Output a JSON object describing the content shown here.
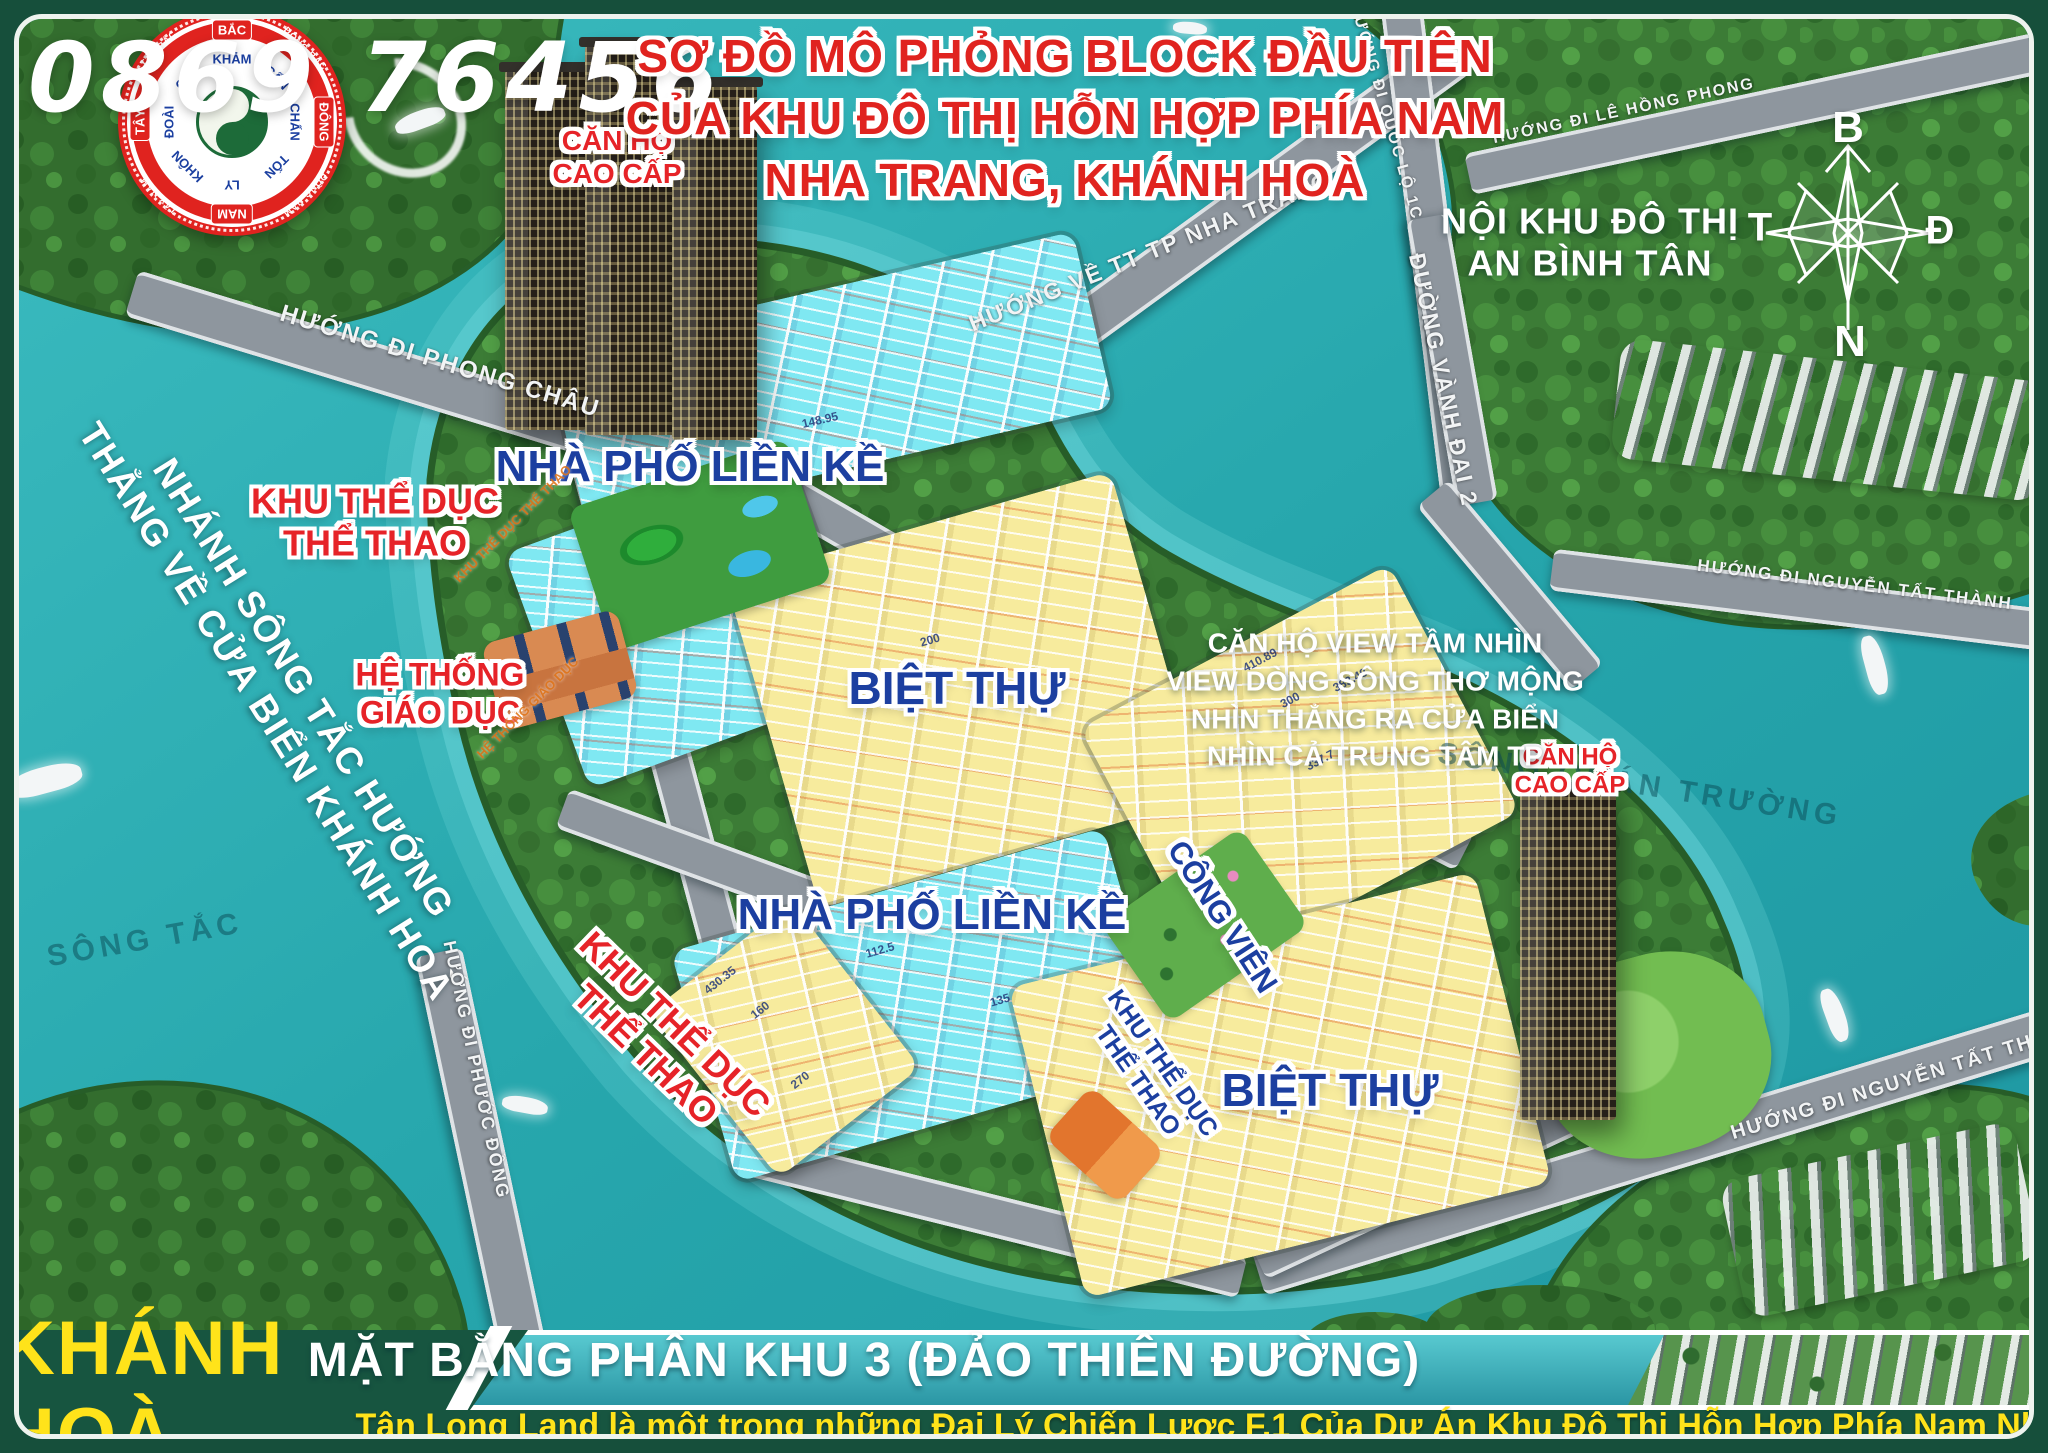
{
  "phone": {
    "part1": "0869",
    "part2": "76456"
  },
  "logo": {
    "cardinals": {
      "n": "BẮC",
      "e": "ĐÔNG",
      "s": "NAM",
      "w": "TÂY"
    },
    "intercardinals": {
      "ne": "ĐÔNG BẮC",
      "se": "ĐÔNG NAM",
      "sw": "TÂY NAM",
      "nw": "TÂY BẮC"
    },
    "trigrams": [
      "KHẢM",
      "CẤN",
      "CHẤN",
      "TỐN",
      "LY",
      "KHÔN",
      "ĐOÀI",
      "CÀN"
    ]
  },
  "title": {
    "line1": "SƠ ĐỒ MÔ PHỎNG BLOCK ĐẦU TIÊN",
    "line2": "CỦA KHU ĐÔ THỊ HỖN HỢP PHÍA NAM",
    "line3": "NHA TRANG, KHÁNH HOÀ"
  },
  "compass": {
    "north": "B",
    "east": "Đ",
    "south": "N",
    "west": "T"
  },
  "labels": {
    "noi_khu_line1": "NỘI KHU ĐÔ THỊ",
    "noi_khu_line2": "AN BÌNH TÂN",
    "can_ho_top_line1": "CĂN HỘ",
    "can_ho_top_line2": "CAO CẤP",
    "can_ho_right_line1": "CĂN HỘ",
    "can_ho_right_line2": "CAO CẤP",
    "nha_pho_1": "NHÀ  PHỐ LIỀN KỀ",
    "nha_pho_2": "NHÀ  PHỐ LIỀN KỀ",
    "biet_thu_1": "BIỆT THỰ",
    "biet_thu_2": "BIỆT THỰ",
    "ktd1_line1": "KHU THỂ DỤC",
    "ktd1_line2": "THỂ THAO",
    "ktd2_line1": "KHU THỂ DỤC",
    "ktd2_line2": "THỂ THAO",
    "ktd3_line1": "KHU THỂ DỤC",
    "ktd3_line2": "THỂ THAO",
    "giao_duc_line1": "HỆ THỐNG",
    "giao_duc_line2": "GIÁO DỤC",
    "cong_vien": "CÔNG VIÊN",
    "view_line1": "CĂN HỘ VIEW TẦM NHÌN",
    "view_line2": "VIEW DÒNG SÔNG THƠ MỘNG",
    "view_line3": "NHÌN THẲNG RA CỬA BIỂN",
    "view_line4": "NHÌN CẢ TRUNG TÂM TP",
    "wm_sport": "KHU THỂ DỤC THỂ THAO",
    "wm_school": "HỆ THỐNG GIÁO DỤC"
  },
  "rivers": {
    "song_tac": "SÔNG TẮC",
    "song_quan_truong": "SÔNG QUÁN TRƯỜNG",
    "branch_line1": "NHÁNH SÔNG TẮC HƯỚNG",
    "branch_line2": "THẲNG VỀ CỬA BIỂN KHÁNH HOÀ"
  },
  "roads": {
    "phong_chau": "HƯỚNG ĐI PHONG CHÂU",
    "tt_nha_trang": "HƯỚNG VỀ TT TP NHA TRANG",
    "quoc_lo_1c": "HƯỚNG ĐI QUỐC LỘ 1C",
    "le_hong_phong": "HƯỚNG ĐI LÊ HỒNG PHONG",
    "vanh_dai_2": "ĐƯỜNG VÀNH ĐAI 2",
    "nguyen_tat_thanh_top": "HƯỚNG ĐI NGUYỄN TẤT THÀNH",
    "nguyen_tat_thanh_bottom": "HƯỚNG ĐI NGUYỄN TẤT THÀNH",
    "phuoc_dong": "HƯỚNG ĐI PHƯỚC ĐỒNG"
  },
  "footer": {
    "province": "KHÁNH HOÀ",
    "plan_title": "MẶT BẰNG PHÂN KHU 3 (ĐẢO THIÊN ĐƯỜNG)",
    "tagline": "Tân Long Land là một trong những Đại Lý Chiến Lược F.1 Của Dự Án Khu Đô Thị Hỗn Hợp Phía Nam Nha Trang"
  },
  "lot_samples": [
    "150",
    "200",
    "300",
    "112.5",
    "135",
    "160",
    "270",
    "148.95",
    "430.35",
    "337.7",
    "383.48",
    "410.89"
  ],
  "colors": {
    "water": "#27a7ad",
    "frame-green": "#164f3b",
    "footer-green": "#175540",
    "accent-yellow": "#ffe31a",
    "label-red": "#e62328",
    "label-blue": "#1c3fa0",
    "lot-cyan": "#7fe8f2",
    "lot-yellow": "#f7eb9d",
    "road-gray": "#8e969e",
    "land-green": "#3c7c36"
  }
}
